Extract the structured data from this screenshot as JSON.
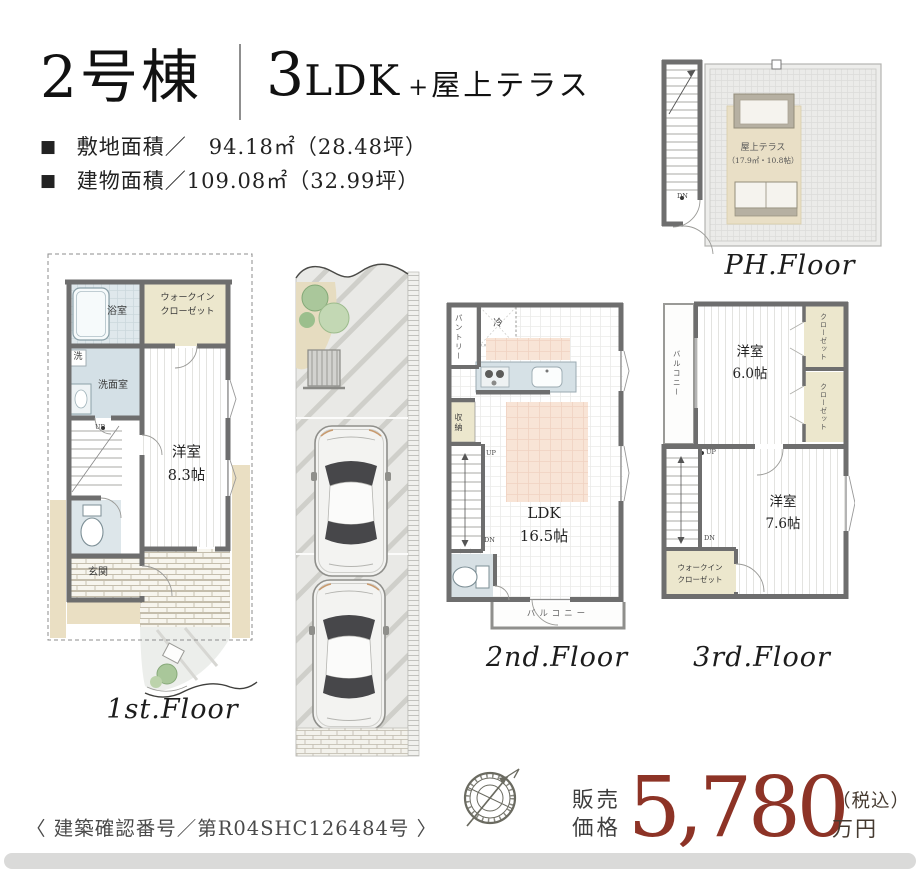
{
  "header": {
    "building_name": "2号棟",
    "plan_number": "3",
    "plan_type": "LDK",
    "plan_plus": "+",
    "plan_extra": "屋上テラス",
    "area_lines": [
      {
        "bullet": "■",
        "text": "敷地面積／　94.18㎡（28.48坪）"
      },
      {
        "bullet": "■",
        "text": "建物面積／109.08㎡（32.99坪）"
      }
    ]
  },
  "floors": {
    "first": {
      "label": "1st.Floor",
      "bath": "浴室",
      "walk_in_closet": "ウォークイン\nクローゼット",
      "washer": "洗",
      "washroom": "洗面室",
      "bedroom": "洋室\n8.3帖",
      "entrance": "玄関",
      "up": "UP"
    },
    "second": {
      "label": "2nd.Floor",
      "pantry": "パントリー",
      "fridge": "冷",
      "storage": "収納",
      "ldk": "LDK\n16.5帖",
      "balcony": "バルコニー",
      "up": "UP",
      "down": "DN"
    },
    "third": {
      "label": "3rd.Floor",
      "balcony": "バルコニー",
      "bedroom_small": "洋室\n6.0帖",
      "closet_upper": "クローゼット",
      "closet_lower": "クローゼット",
      "bedroom_large": "洋室\n7.6帖",
      "walk_in_closet": "ウォークイン\nクローゼット",
      "up": "UP",
      "down": "DN"
    },
    "ph": {
      "label": "PH.Floor",
      "terrace_name": "屋上テラス",
      "terrace_size": "（17.9㎡・10.8帖）",
      "down": "DN"
    }
  },
  "price": {
    "label_top": "販売",
    "label_bottom": "価格",
    "amount": "5,780",
    "tax": "（税込）",
    "unit": "万円"
  },
  "footer": {
    "confirmation": "〈 建築確認番号／第R04SHC126484号 〉"
  },
  "icons": {
    "compass": "compass-rose"
  },
  "colors": {
    "accent_red": "#8d3326",
    "wall_gray": "#6e6e6e",
    "bath_blue": "#d4e0e6",
    "closet_cream": "#ece7cd",
    "rug_peach": "#f8e4d6",
    "driveway_gray": "#e9e9e6"
  }
}
